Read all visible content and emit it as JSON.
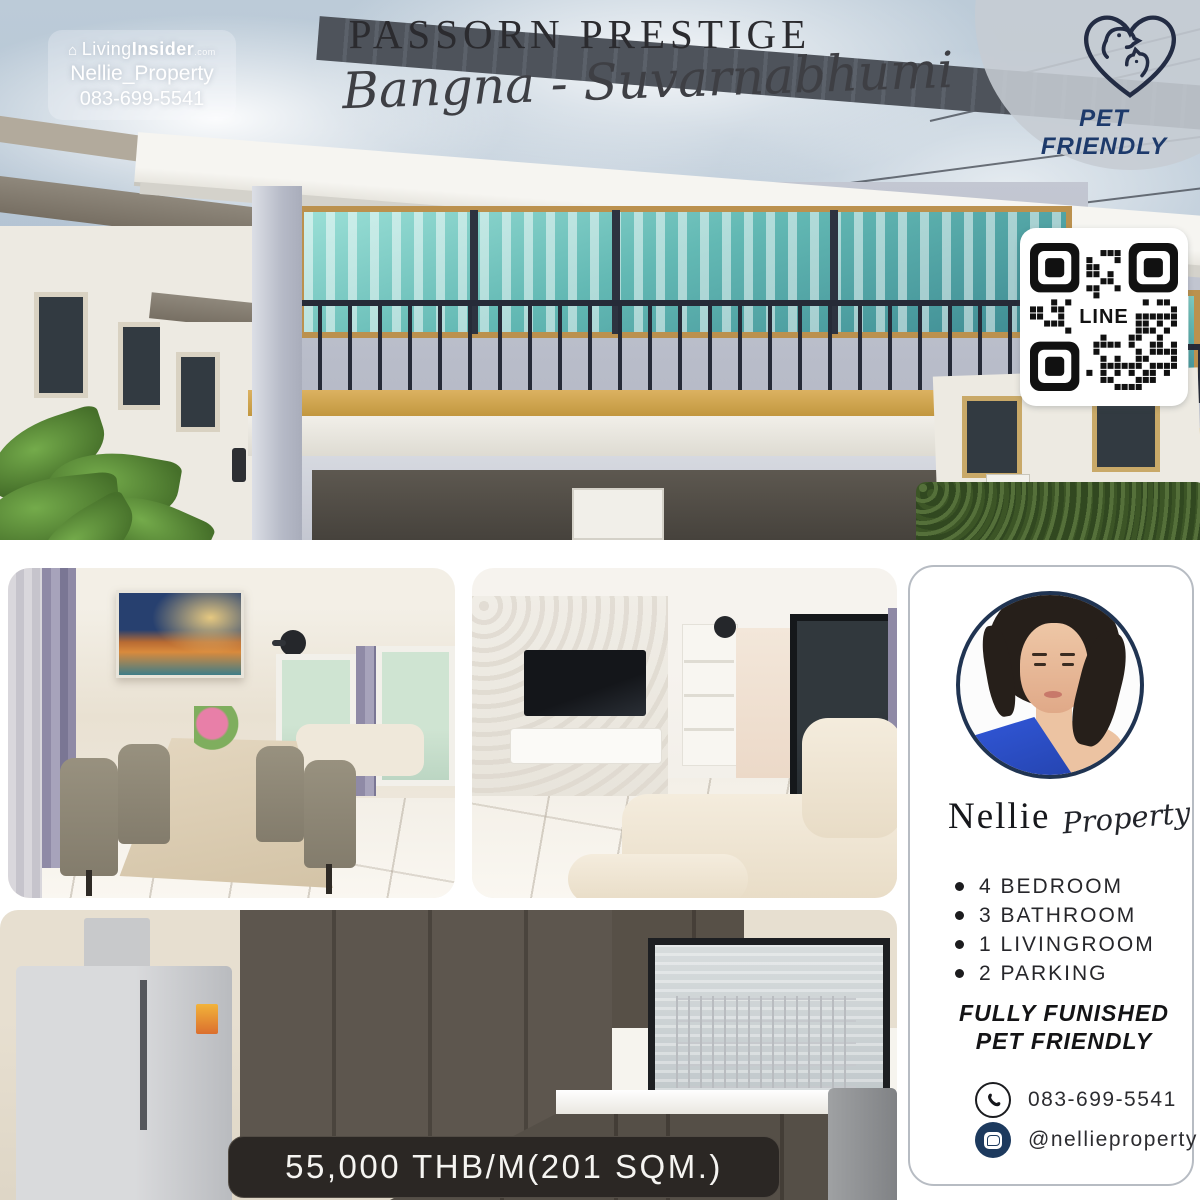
{
  "hero": {
    "brand_badge": {
      "brand": "Living",
      "brand_bold": "Insider",
      "brand_suffix": ".com",
      "agent_name": "Nellie_Property",
      "phone": "083-699-5541"
    },
    "title": "PASSORN PRESTIGE",
    "subtitle": "Bangna - Suvarnabhumi",
    "pet_badge_label": "PET FRIENDLY",
    "qr_label": "LINE"
  },
  "price_banner": {
    "text": "55,000 THB/M(201 SQM.)"
  },
  "agent_card": {
    "name_primary": "Nellie",
    "name_secondary": "Property",
    "features": [
      "4 BEDROOM",
      "3 BATHROOM",
      "1 LIVINGROOM",
      "2 PARKING"
    ],
    "highlights": [
      "FULLY FUNISHED",
      "PET FRIENDLY"
    ],
    "contacts": {
      "phone": "083-699-5541",
      "line": "@nellieproperty"
    }
  },
  "colors": {
    "accent_navy": "#1d3a6b",
    "railing_navy": "#262b38",
    "gold_trim": "#c9a153",
    "glass_teal": "#63b9b4",
    "banner_bg": "#2b2724",
    "sky": "#b4c4d3"
  }
}
